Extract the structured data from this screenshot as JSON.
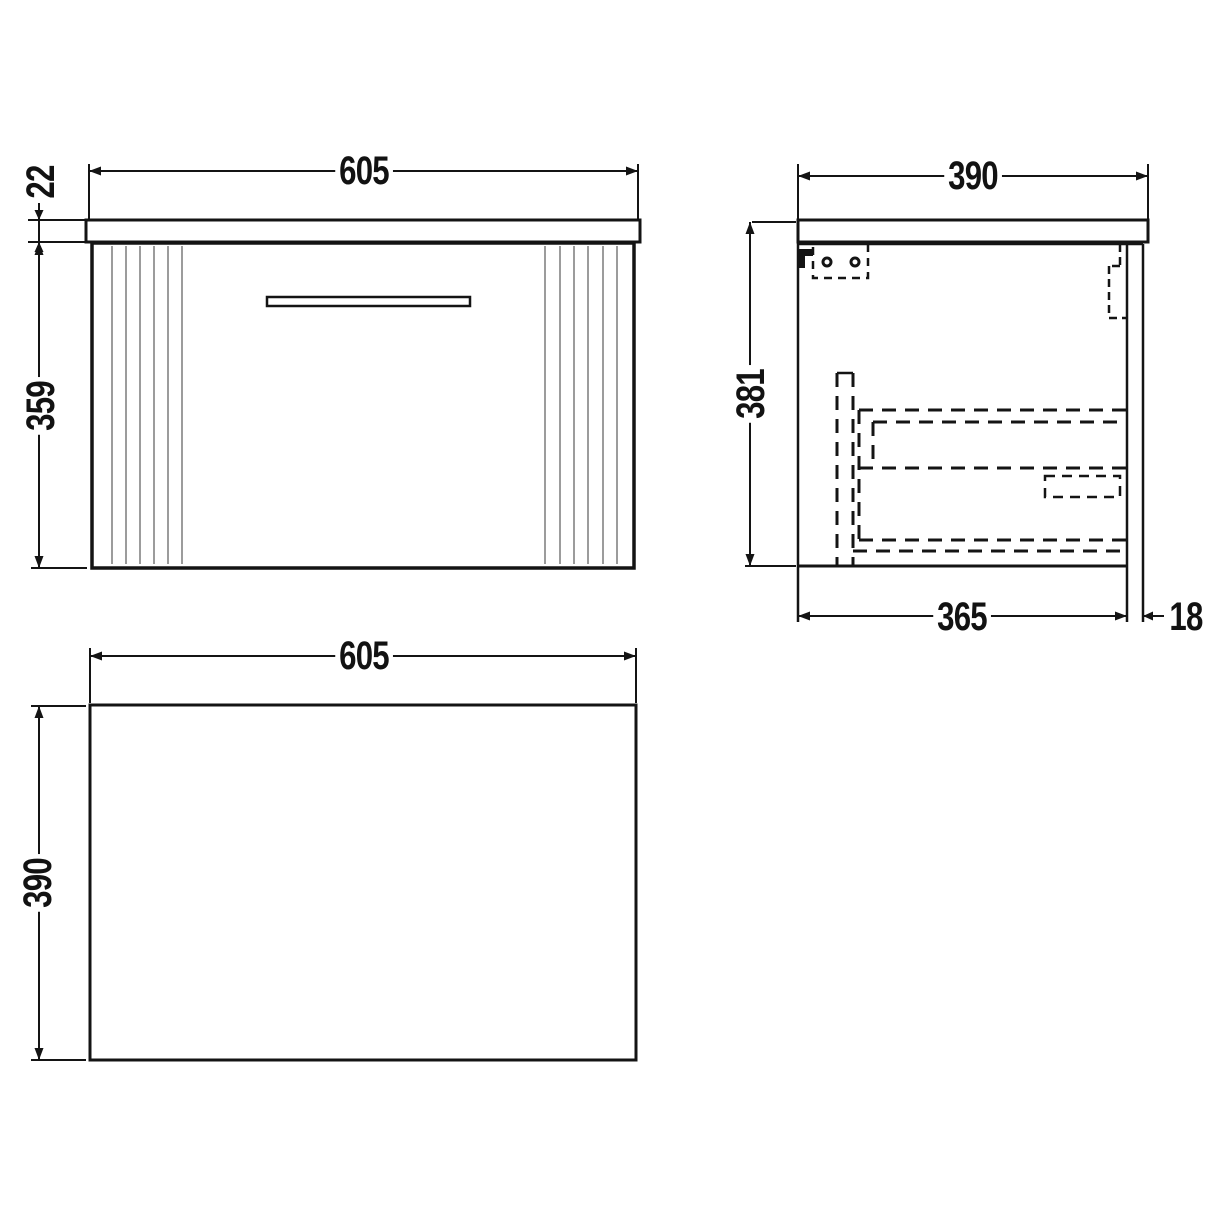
{
  "page": {
    "background": "#ffffff"
  },
  "drawing": {
    "type": "technical-dimension-drawing",
    "subject": "wall-hung vanity unit with worktop, fluted drawer front and end panel",
    "units": "mm",
    "line_color": "#141414",
    "flute_color": "#9c9c9c",
    "views": {
      "front": {
        "label": "front elevation",
        "dims": {
          "width": "605",
          "worktop_thickness": "22",
          "cabinet_height": "359"
        }
      },
      "side": {
        "label": "side section",
        "dims": {
          "overall_depth": "390",
          "overall_height": "381",
          "cabinet_depth": "365",
          "panel_thickness": "18"
        }
      },
      "plan": {
        "label": "plan view",
        "dims": {
          "width": "605",
          "depth": "390"
        }
      }
    }
  }
}
